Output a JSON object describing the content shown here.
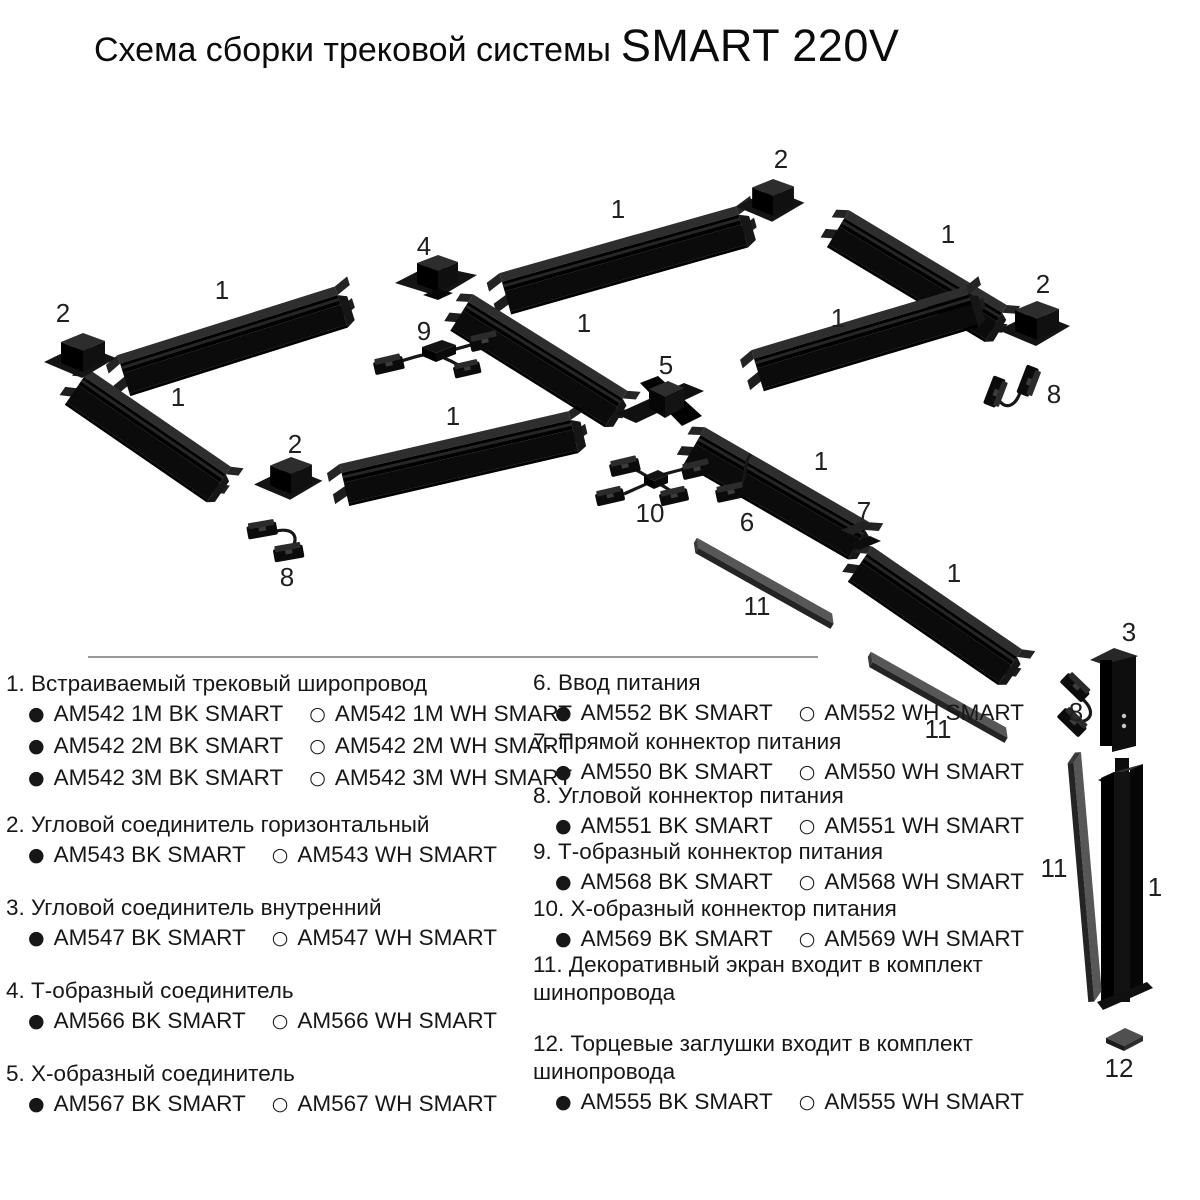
{
  "title": {
    "main": "Схема сборки трековой системы",
    "brand": "SMART 220V"
  },
  "icons": {
    "filled": "●",
    "empty": "○"
  },
  "legend": {
    "left": [
      {
        "label": "1. Встраиваемый трековый широпровод",
        "rows": [
          {
            "bk": "AM542 1M BK SMART",
            "wh": "AM542 1M WH SMART"
          },
          {
            "bk": "AM542 2M BK SMART",
            "wh": "AM542 2M WH SMART"
          },
          {
            "bk": "AM542 3M BK SMART",
            "wh": "AM542 3M WH SMART"
          }
        ]
      },
      {
        "label": "2. Угловой соединитель горизонтальный",
        "rows": [
          {
            "bk": "AM543 BK SMART",
            "wh": "AM543 WH SMART"
          }
        ]
      },
      {
        "label": "3. Угловой соединитель внутренний",
        "rows": [
          {
            "bk": "AM547 BK SMART",
            "wh": "AM547 WH SMART"
          }
        ]
      },
      {
        "label": "4. Т-образный соединитель",
        "rows": [
          {
            "bk": "AM566 BK SMART",
            "wh": "AM566 WH SMART"
          }
        ]
      },
      {
        "label": "5. Х-образный соединитель",
        "rows": [
          {
            "bk": "AM567 BK SMART",
            "wh": "AM567 WH SMART"
          }
        ]
      }
    ],
    "right": [
      {
        "label": "6. Ввод питания",
        "rows": [
          {
            "bk": "AM552 BK SMART",
            "wh": "AM552 WH SMART"
          }
        ]
      },
      {
        "label": "7. Прямой коннектор питания",
        "rows": [
          {
            "bk": "AM550 BK SMART",
            "wh": "AM550 WH SMART"
          }
        ]
      },
      {
        "label": "8. Угловой коннектор питания",
        "rows": [
          {
            "bk": "AM551 BK SMART",
            "wh": "AM551 WH SMART"
          }
        ]
      },
      {
        "label": "9. Т-образный коннектор питания",
        "rows": [
          {
            "bk": "AM568 BK SMART",
            "wh": "AM568 WH SMART"
          }
        ]
      },
      {
        "label": "10. Х-образный коннектор питания",
        "rows": [
          {
            "bk": "AM569 BK SMART",
            "wh": "AM569 WH SMART"
          }
        ]
      },
      {
        "label": "11. Декоративный экран входит в комплект шинопровода",
        "rows": []
      },
      {
        "label": "12. Торцевые заглушки  входит в комплект шинопровода",
        "rows": [
          {
            "bk": "AM555 BK SMART",
            "wh": "AM555 WH SMART"
          }
        ]
      }
    ]
  },
  "diagram": {
    "labels": [
      {
        "n": "2",
        "x": 63,
        "y": 313
      },
      {
        "n": "1",
        "x": 222,
        "y": 290
      },
      {
        "n": "4",
        "x": 424,
        "y": 246
      },
      {
        "n": "1",
        "x": 618,
        "y": 209
      },
      {
        "n": "2",
        "x": 781,
        "y": 159
      },
      {
        "n": "1",
        "x": 948,
        "y": 234
      },
      {
        "n": "2",
        "x": 1043,
        "y": 284
      },
      {
        "n": "1",
        "x": 178,
        "y": 397
      },
      {
        "n": "9",
        "x": 424,
        "y": 331
      },
      {
        "n": "1",
        "x": 584,
        "y": 323
      },
      {
        "n": "5",
        "x": 666,
        "y": 365
      },
      {
        "n": "1",
        "x": 838,
        "y": 318
      },
      {
        "n": "8",
        "x": 1054,
        "y": 394
      },
      {
        "n": "1",
        "x": 453,
        "y": 416
      },
      {
        "n": "2",
        "x": 295,
        "y": 444
      },
      {
        "n": "1",
        "x": 821,
        "y": 461
      },
      {
        "n": "10",
        "x": 650,
        "y": 513
      },
      {
        "n": "6",
        "x": 747,
        "y": 522
      },
      {
        "n": "7",
        "x": 864,
        "y": 511
      },
      {
        "n": "8",
        "x": 287,
        "y": 577
      },
      {
        "n": "11",
        "x": 757,
        "y": 606
      },
      {
        "n": "1",
        "x": 954,
        "y": 573
      },
      {
        "n": "11",
        "x": 938,
        "y": 729
      },
      {
        "n": "3",
        "x": 1129,
        "y": 632
      },
      {
        "n": "8",
        "x": 1076,
        "y": 712
      },
      {
        "n": "11",
        "x": 1054,
        "y": 868
      },
      {
        "n": "1",
        "x": 1155,
        "y": 887
      },
      {
        "n": "12",
        "x": 1119,
        "y": 1068
      }
    ],
    "tracks": [
      {
        "x": 118,
        "y": 357,
        "r": -17.5,
        "len": 228
      },
      {
        "x": 88,
        "y": 371,
        "r": 34.5,
        "len": 172
      },
      {
        "x": 340,
        "y": 466,
        "r": -13,
        "len": 235
      },
      {
        "x": 500,
        "y": 275,
        "r": -15.8,
        "len": 246
      },
      {
        "x": 472,
        "y": 296,
        "r": 32,
        "len": 182
      },
      {
        "x": 848,
        "y": 212,
        "r": 31,
        "len": 184
      },
      {
        "x": 752,
        "y": 352,
        "r": -16.6,
        "len": 224
      },
      {
        "x": 704,
        "y": 429,
        "r": 30,
        "len": 190
      },
      {
        "x": 871,
        "y": 548,
        "r": 34.5,
        "len": 182
      },
      {
        "x": 1101,
        "y": 772,
        "vertical": true
      }
    ],
    "screens": [
      {
        "x": 698,
        "y": 536,
        "r": 31.5,
        "s": 0.95
      },
      {
        "x": 872,
        "y": 650,
        "r": 31.5,
        "s": 0.95
      },
      {
        "x": 1083,
        "y": 752,
        "r": 86.5,
        "s": 1.47
      }
    ],
    "connectors": [
      {
        "type": "corner",
        "x": 44,
        "y": 332
      },
      {
        "type": "corner",
        "x": 254,
        "y": 456,
        "s": 0.95
      },
      {
        "type": "corner",
        "x": 736,
        "y": 178,
        "s": 0.95
      },
      {
        "type": "corner",
        "x": 998,
        "y": 300
      },
      {
        "type": "tee",
        "x": 395,
        "y": 257
      },
      {
        "type": "cross",
        "x": 616,
        "y": 376
      },
      {
        "type": "corner-v",
        "x": 1090,
        "y": 644
      },
      {
        "type": "power-in",
        "x": 716,
        "y": 460
      },
      {
        "type": "power-straight",
        "x": 841,
        "y": 520
      },
      {
        "type": "power-corner",
        "x": 1044,
        "y": 374,
        "r": 125
      },
      {
        "type": "power-corner",
        "x": 248,
        "y": 520,
        "r": 4
      },
      {
        "type": "power-corner",
        "x": 1075,
        "y": 670,
        "r": 58
      },
      {
        "type": "power-tee",
        "x": 372,
        "y": 330
      },
      {
        "type": "power-cross",
        "x": 596,
        "y": 448
      },
      {
        "type": "cap",
        "x": 1106,
        "y": 1028
      }
    ]
  }
}
